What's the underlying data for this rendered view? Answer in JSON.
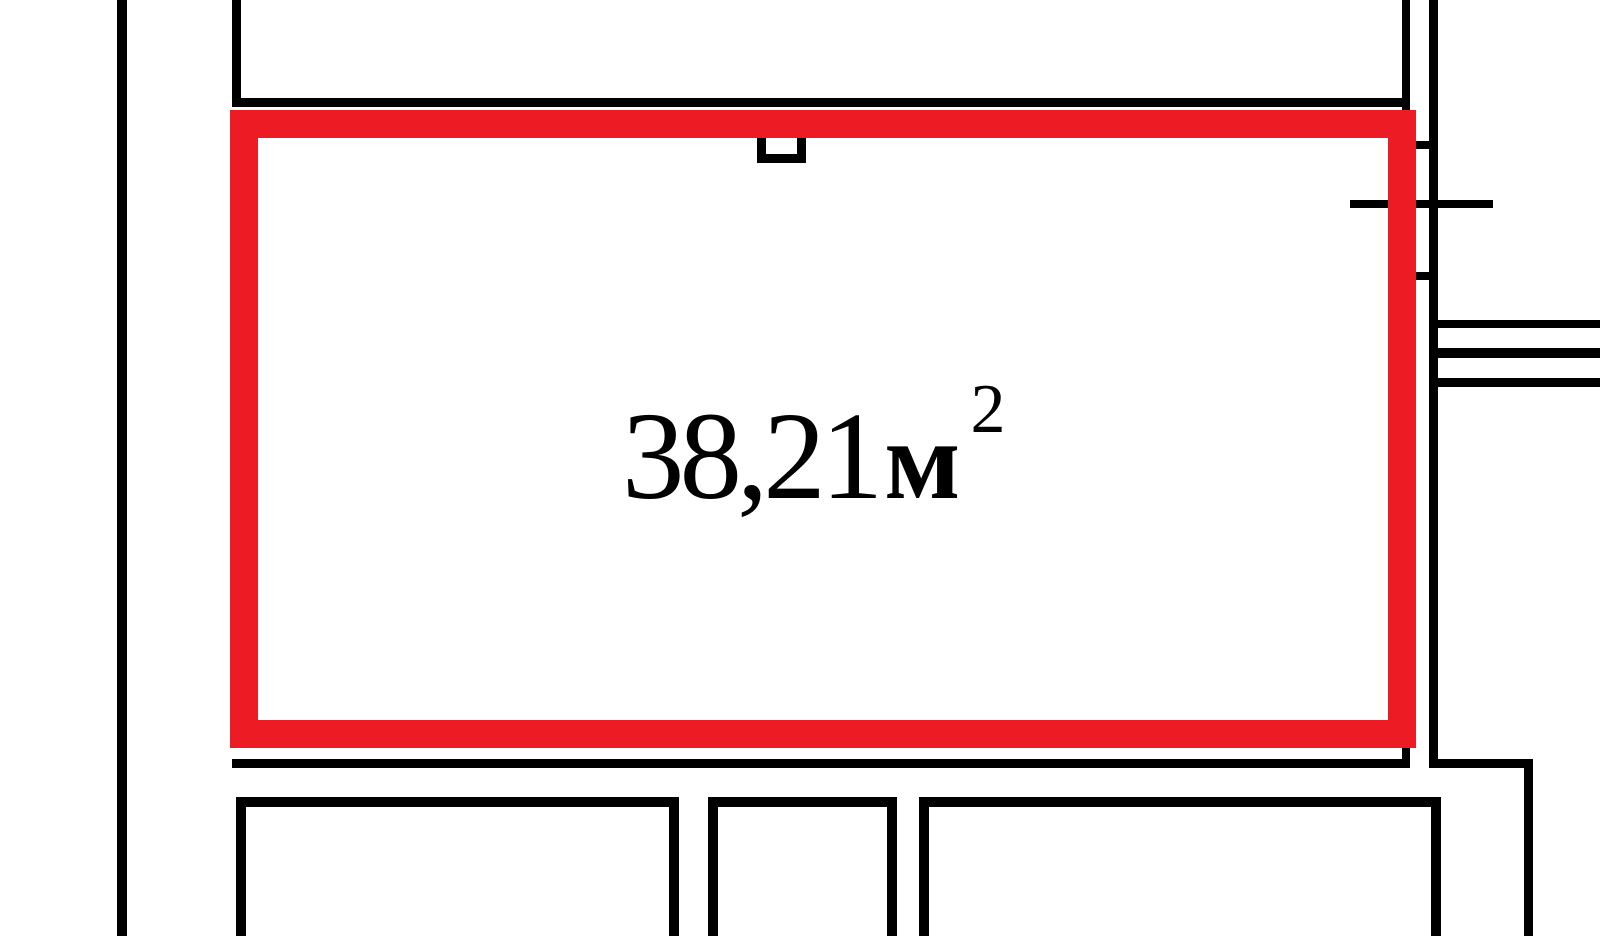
{
  "plan": {
    "type": "floor-plan",
    "highlighted_room": {
      "area_label": {
        "value": "38,21",
        "unit": "м",
        "superscript": "2"
      }
    },
    "colors": {
      "highlight_red": "#ed1c24",
      "wall_black": "#000000",
      "background_white": "#ffffff"
    }
  }
}
